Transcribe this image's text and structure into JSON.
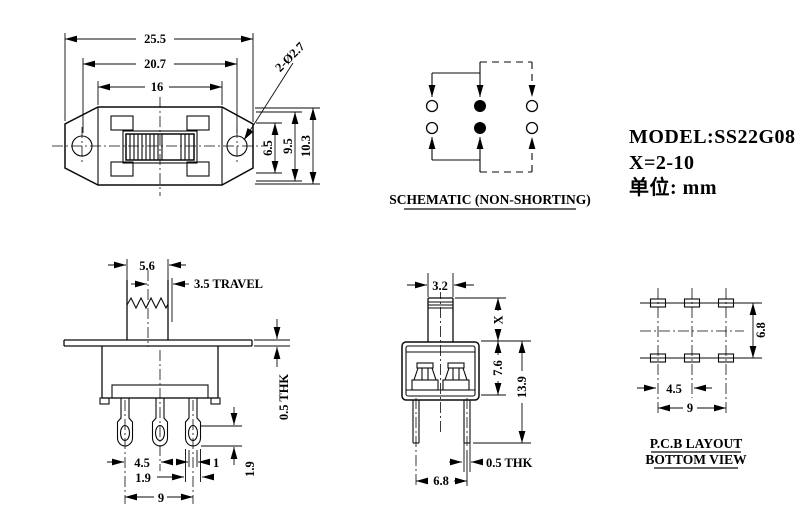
{
  "title_block": {
    "model": "MODEL:SS22G08",
    "x_range": "X=2-10",
    "unit": "单位: mm"
  },
  "top_view": {
    "dim_total_width": "25.5",
    "dim_hole_pitch": "20.7",
    "dim_body_width": "16",
    "dim_hole_callout": "2-Ø2.7",
    "dim_inner_height": "6.5",
    "dim_mid_height": "9.5",
    "dim_total_height": "10.3"
  },
  "schematic": {
    "title": "SCHEMATIC (NON-SHORTING)"
  },
  "front_view": {
    "dim_knob_width": "5.6",
    "dim_travel": "3.5 TRAVEL",
    "dim_flange_thickness": "0.5 THK",
    "dim_pin_pitch": "4.5",
    "dim_pin_width": "1",
    "dim_pin_tip_width": "1.9",
    "dim_pin_hole_offset": "1.9",
    "dim_pin_span": "9"
  },
  "side_view": {
    "dim_knob_depth": "3.2",
    "dim_actuator_height": "X",
    "dim_body_height": "7.6",
    "dim_total_height": "13.9",
    "dim_pin_thickness": "0.5 THK",
    "dim_pin_spacing": "6.8"
  },
  "pcb_layout": {
    "label_line1": "P.C.B LAYOUT",
    "label_line2": "BOTTOM VIEW",
    "dim_pad_pitch": "4.5",
    "dim_pad_span": "9",
    "dim_row_spacing": "6.8"
  }
}
